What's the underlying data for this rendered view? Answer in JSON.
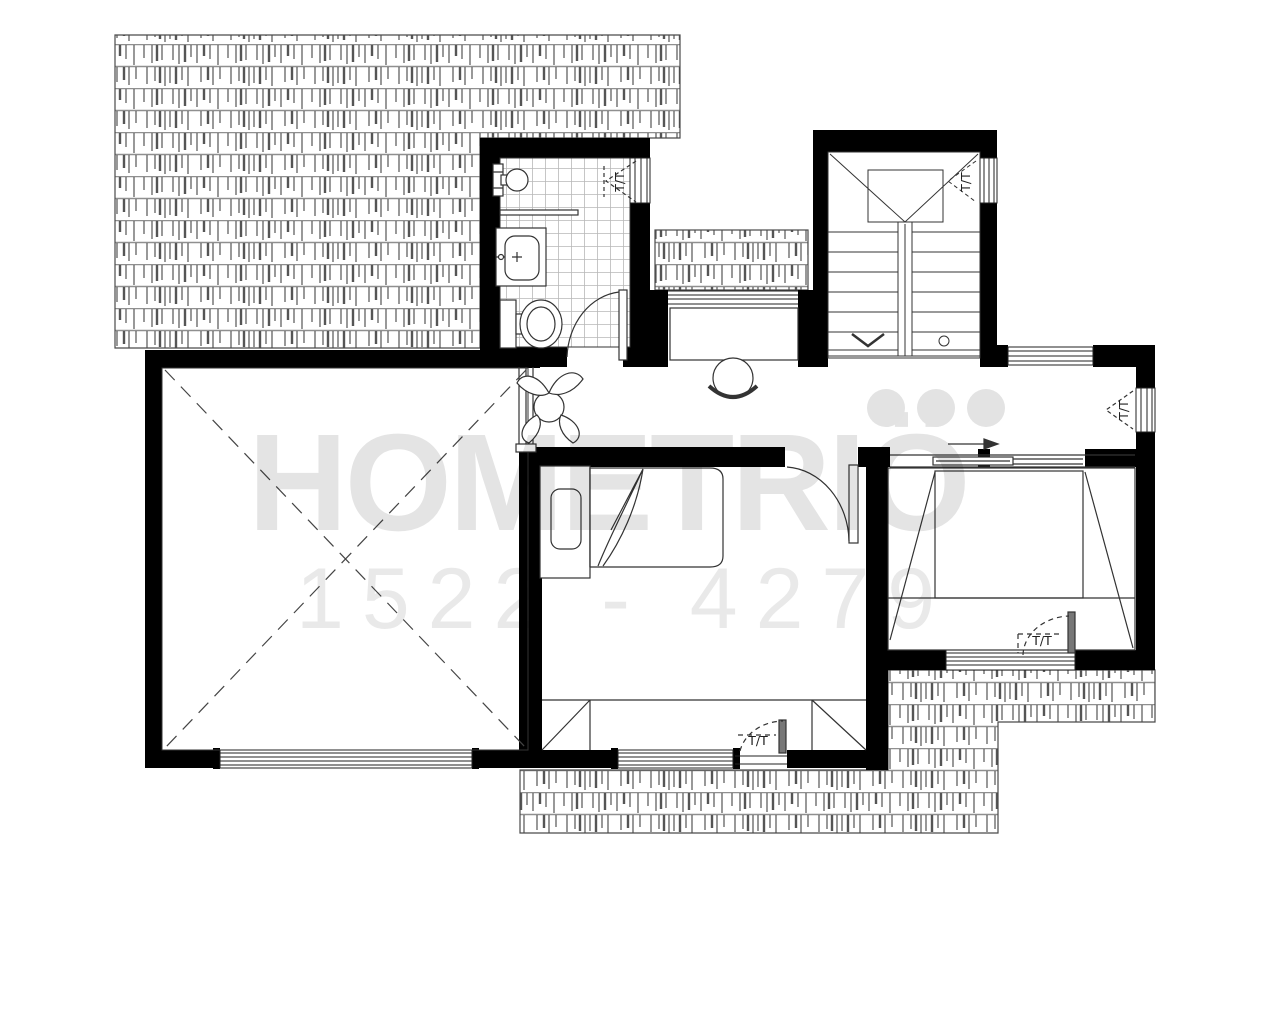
{
  "watermark": {
    "brand": "HOMETRIÖ",
    "serial": "1522 - 4279"
  },
  "labels": {
    "bathroom_window": "T/T",
    "stair_window": "T/T",
    "hall_window": "T/T",
    "bedroom_middle_window": "T/T",
    "bedroom_right_window": "T/T"
  },
  "colors": {
    "wall": "#000000",
    "line": "#2f2f2f",
    "roof_line": "#5a5a5a",
    "tile_line": "#b8b8b8",
    "watermark_text": "#e4e4e4"
  }
}
